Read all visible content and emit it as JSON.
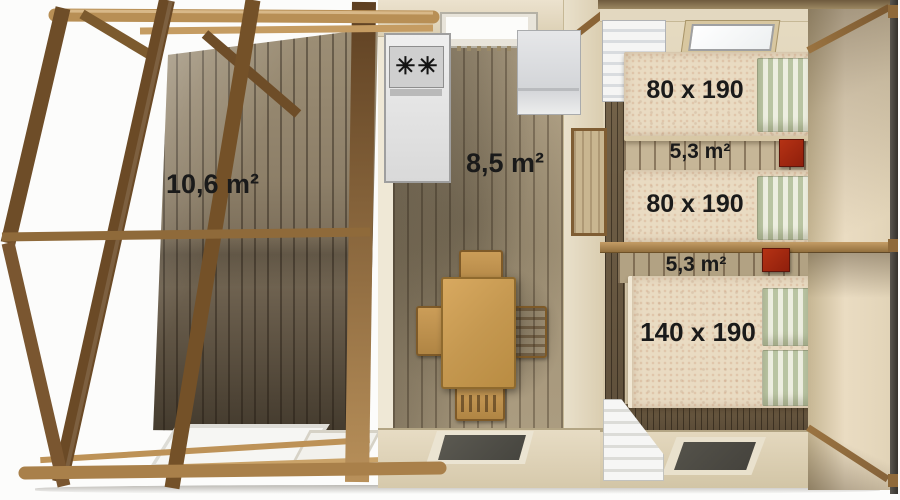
{
  "rooms": {
    "terrace": {
      "area_label": "10,6 m²"
    },
    "living_kitchen": {
      "area_label": "8,5 m²"
    },
    "bedroom_twin": {
      "area_label": "5,3 m²",
      "bed_top_size": "80 x 190",
      "bed_bottom_size": "80 x 190"
    },
    "bedroom_double": {
      "area_label": "5,3 m²",
      "bed_size": "140 x 190"
    }
  },
  "icons": {
    "stove_burner": "✳"
  },
  "colors": {
    "beam_wood": "#b88f55",
    "dark_post_wood": "#6b4a26",
    "deck_wood": "#94866d",
    "wall_beige": "#e4dac3",
    "floor_wood": "#a2937a",
    "bed_linen": "#e9dbc2",
    "pillow_stripe_green": "#b9c4a2",
    "accent_red": "#a52912",
    "kitchen_white": "#e2e2e2"
  }
}
